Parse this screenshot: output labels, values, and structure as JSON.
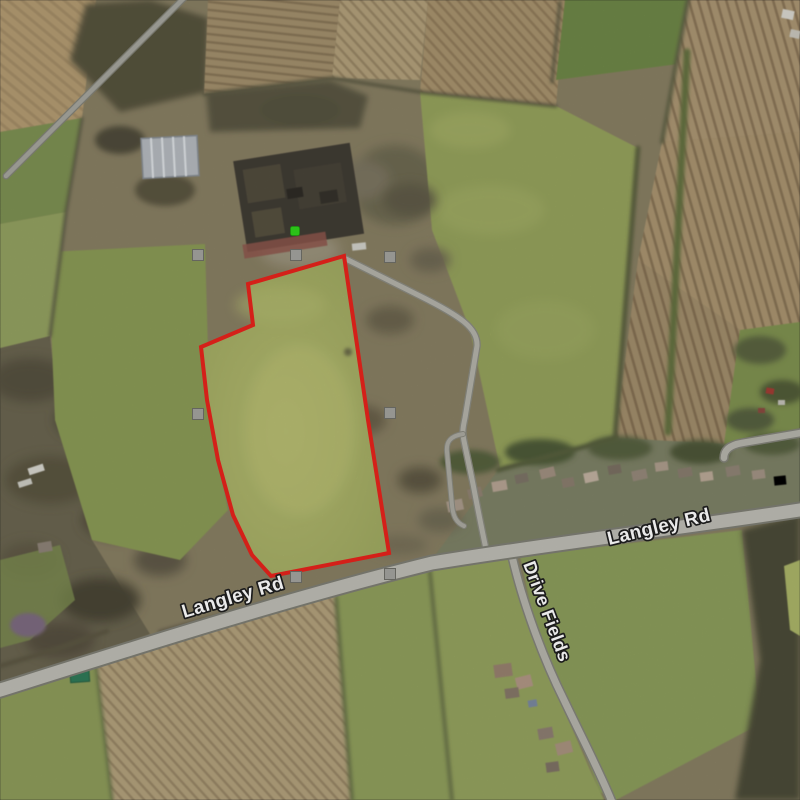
{
  "map": {
    "view_type": "satellite",
    "road_labels": [
      {
        "id": "langley-rd-west",
        "text": "Langley Rd"
      },
      {
        "id": "langley-rd-east",
        "text": "Langley Rd"
      },
      {
        "id": "drive-fields",
        "text": "Drive Fields"
      }
    ],
    "parcel": {
      "boundary_color": "#e8231c",
      "points": "344,256 248,284 253,325 201,347 207,400 218,460 233,515 252,555 271,576 389,553 368,420"
    },
    "markers": {
      "selected_color": "#2fd31b",
      "handle_color": "#a3a39e",
      "handle_count": 7
    }
  }
}
